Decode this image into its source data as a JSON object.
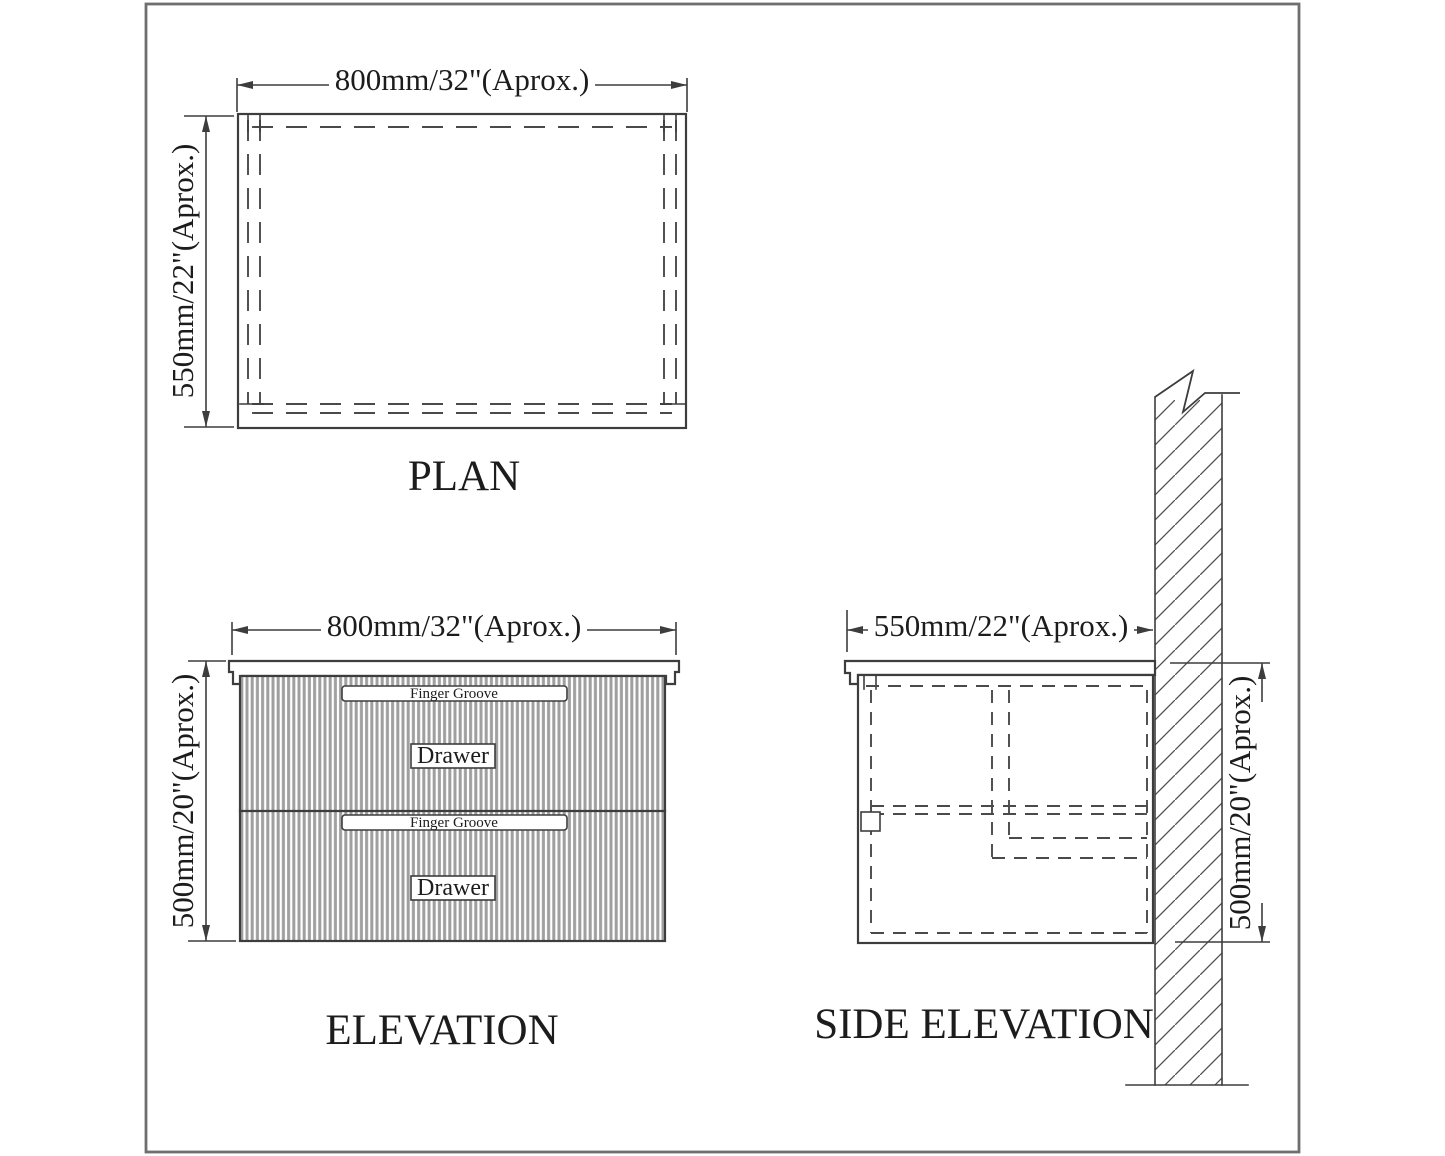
{
  "colors": {
    "background": "#ffffff",
    "frame": "#6f6f6f",
    "line": "#3d3d3d",
    "dash": "#4a4a4a",
    "flute": "#9f9f9f",
    "hatch": "#505050",
    "ink": "#1c1c1c"
  },
  "plan": {
    "title": "PLAN",
    "dim_width": "800mm/32\"(Aprox.)",
    "dim_depth": "550mm/22\"(Aprox.)"
  },
  "elevation": {
    "title": "ELEVATION",
    "dim_width": "800mm/32\"(Aprox.)",
    "dim_height": "500mm/20\"(Aprox.)",
    "finger_groove": "Finger Groove",
    "drawer": "Drawer"
  },
  "side_elevation": {
    "title": "SIDE ELEVATION",
    "dim_depth": "550mm/22\"(Aprox.)",
    "dim_height": "500mm/20\"(Aprox.)"
  }
}
